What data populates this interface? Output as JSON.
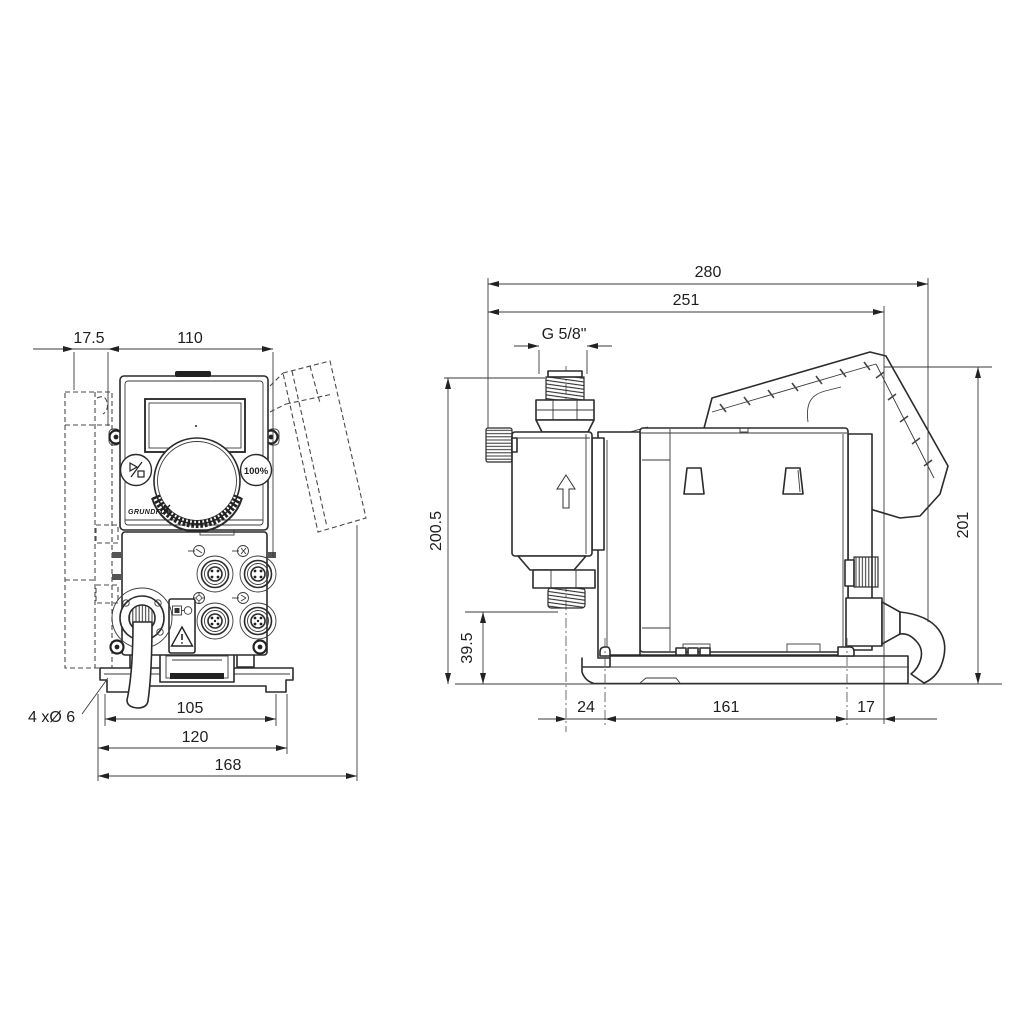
{
  "drawing": {
    "type": "dimensional-drawing",
    "views": [
      "front view",
      "side view"
    ],
    "line_color": "#2b2b2b",
    "background": "#ffffff"
  },
  "front_view": {
    "dims": {
      "bracket_offset": "17.5",
      "housing_width": "110",
      "hole_spacing": "105",
      "plate_width": "120",
      "overall_width": "168",
      "mounting_holes_note": "4 xØ 6"
    },
    "panel": {
      "capacity_button_label": "100%",
      "brand": "GRUNDFOS"
    },
    "icons": [
      "start-stop-icon",
      "capacity-100-icon",
      "warning-triangle-icon",
      "plug-icon",
      "connector-symbol-icons"
    ]
  },
  "side_view": {
    "dims": {
      "overall_depth": "280",
      "depth_to_plate": "251",
      "connection_thread": "G 5/8\"",
      "height_to_connection": "200.5",
      "valve_clearance": "39.5",
      "overall_height": "201",
      "foot_front_offset": "24",
      "foot_spacing": "161",
      "foot_rear_offset": "17"
    },
    "icons": [
      "flow-direction-arrow-icon"
    ]
  }
}
